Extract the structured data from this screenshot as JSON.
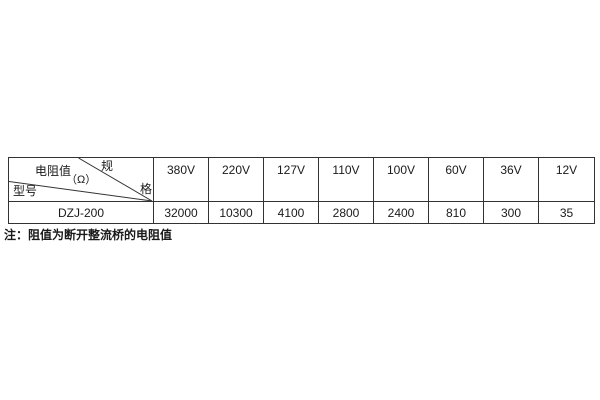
{
  "table": {
    "corner": {
      "spec_char_top": "规",
      "spec_char_bottom": "格",
      "resistance_label": "电阻值",
      "resistance_unit": "（Ω）",
      "model_label": "型号"
    },
    "voltage_headers": [
      "380V",
      "220V",
      "127V",
      "110V",
      "100V",
      "60V",
      "36V",
      "12V"
    ],
    "rows": [
      {
        "model": "DZJ-200",
        "values": [
          "32000",
          "10300",
          "4100",
          "2800",
          "2400",
          "810",
          "300",
          "35"
        ]
      }
    ]
  },
  "note": "注：阻值为断开整流桥的电阻值",
  "colors": {
    "border": "#333333",
    "text": "#1a1a1a",
    "background": "#ffffff"
  }
}
